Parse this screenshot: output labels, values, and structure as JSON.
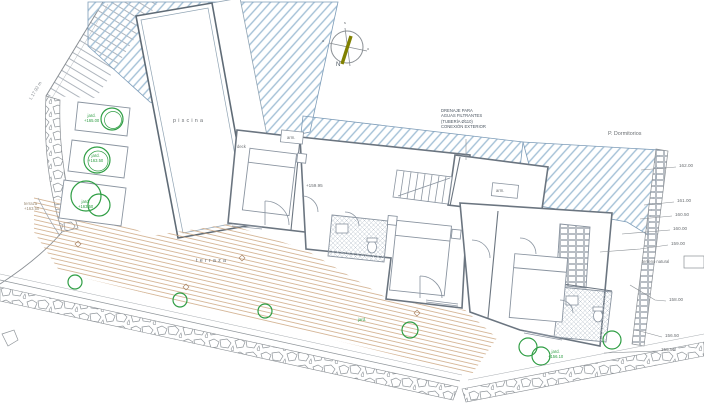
{
  "title_labels": {
    "pool": "piscina",
    "deck": "deck",
    "terrace": "terraza",
    "terrace_small": "terraza",
    "terrace_small_elev": "+163.50",
    "room_elev": "+159.95",
    "wardrobe1": "arm.",
    "wardrobe2": "arm.",
    "floor_title": "P. Dormitorios",
    "terrain": "terreno natural",
    "garden_plain": "jard.",
    "boundary_length": "L 17.92 m"
  },
  "gardens": [
    {
      "name": "jard.",
      "elev": "+165.00"
    },
    {
      "name": "jard.",
      "elev": "+163.50"
    },
    {
      "name": "jard.",
      "elev": "+163.50"
    },
    {
      "name": "jard.",
      "elev": "+156.10"
    }
  ],
  "drain_note": {
    "line1": "DRENAJE PARA",
    "line2": "AGUAS FILTRANTES",
    "line3": "(TUBERÍA Ø110)",
    "line4": "CONEXIÓN EXTERIOR"
  },
  "elevations": [
    "162.00",
    "161.00",
    "160.50",
    "160.00",
    "159.00",
    "158.00",
    "156.50",
    "155.50"
  ],
  "compass": {
    "north": "N",
    "top": "s",
    "left": "a",
    "right": "o"
  },
  "colors": {
    "roof_hatch": "#a3c0d6",
    "deck_line": "#c8a078",
    "tree": "#2f9e44",
    "wall": "#6b7580",
    "text": "#6b6f73",
    "needle": "#808000"
  }
}
